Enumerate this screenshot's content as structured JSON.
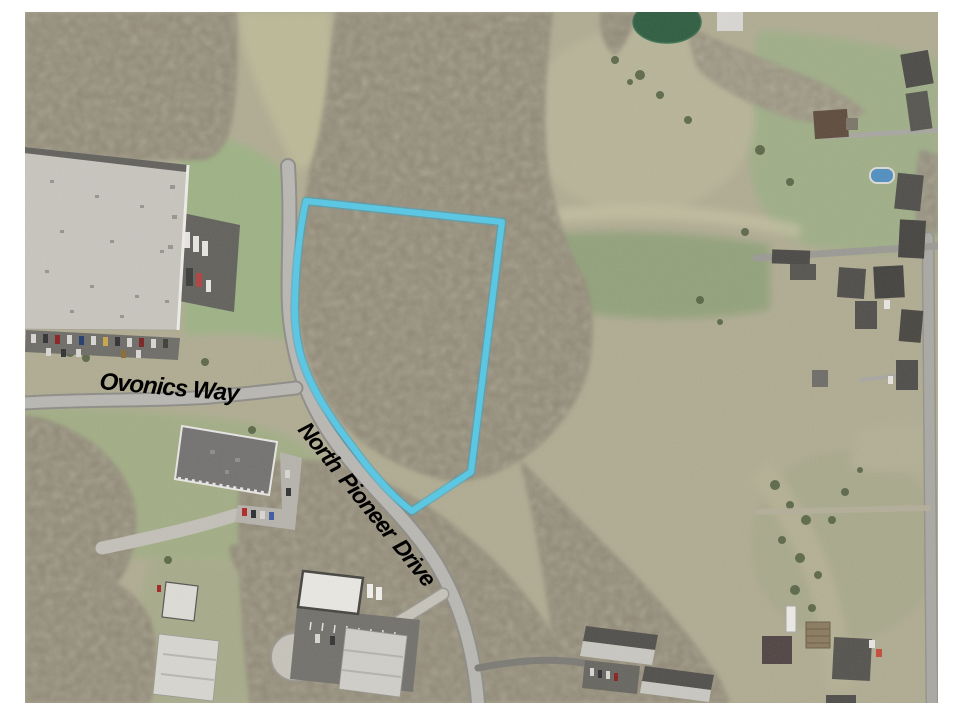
{
  "map": {
    "kind": "aerial-imagery",
    "street_labels": [
      {
        "name": "Ovonics Way"
      },
      {
        "name": "North Pioneer Drive"
      }
    ],
    "parcel_outline_color": "#5BC7E3",
    "label_color": "#000000",
    "background_color": "#FFFFFF"
  }
}
